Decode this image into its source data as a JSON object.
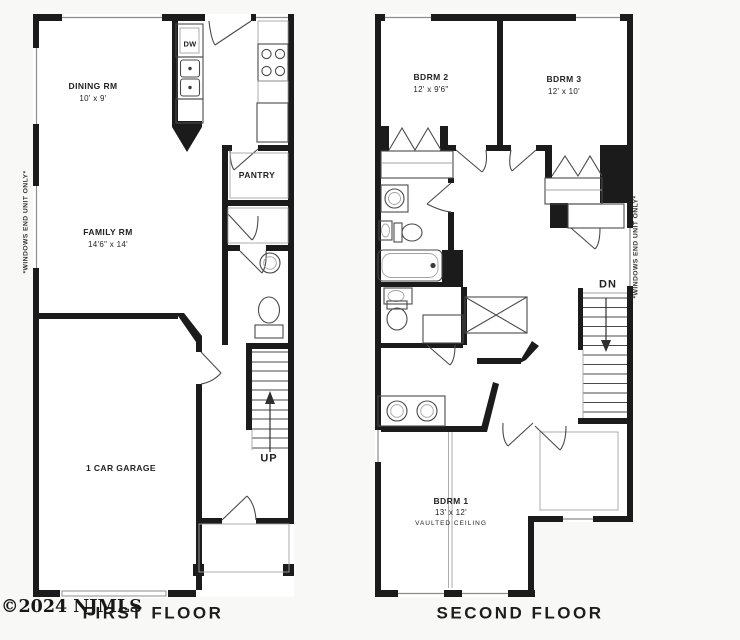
{
  "colors": {
    "wall": "#1b1b1b",
    "line": "#4a4a4a",
    "background": "#f8f8f6",
    "text": "#222222"
  },
  "watermark": "©2024 NJMLS",
  "plans": [
    {
      "title": "FIRST FLOOR",
      "side_note": "*WINDOWS END UNIT ONLY*",
      "rooms": [
        {
          "name": "DINING RM",
          "dims": "10' x 9'"
        },
        {
          "name": "FAMILY RM",
          "dims": "14'6\" x 14'"
        },
        {
          "name": "1 CAR GARAGE",
          "dims": ""
        },
        {
          "name": "PANTRY",
          "dims": ""
        }
      ],
      "labels": {
        "dishwasher": "DW",
        "stairs": "UP"
      }
    },
    {
      "title": "SECOND FLOOR",
      "side_note": "*WINDOWS END UNIT ONLY*",
      "rooms": [
        {
          "name": "BDRM 2",
          "dims": "12' x 9'6\""
        },
        {
          "name": "BDRM 3",
          "dims": "12' x 10'"
        },
        {
          "name": "BDRM 1",
          "dims": "13' x 12'",
          "note": "VAULTED CEILING"
        }
      ],
      "labels": {
        "stairs": "DN"
      }
    }
  ]
}
